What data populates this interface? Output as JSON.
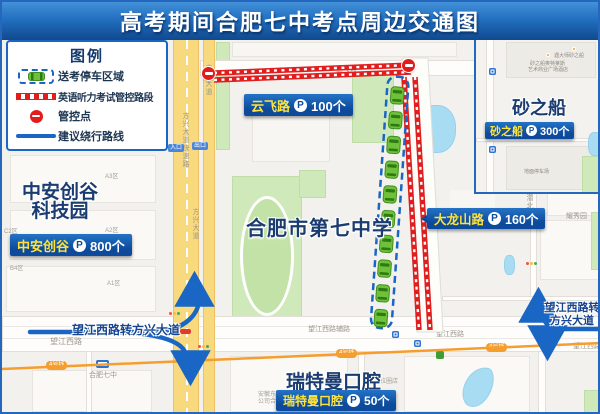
{
  "title": "高考期间合肥七中考点周边交通图",
  "legend": {
    "title": "图例",
    "items": [
      {
        "label": "送考停车区域"
      },
      {
        "label": "英语听力考试管控路段"
      },
      {
        "label": "管控点"
      },
      {
        "label": "建议绕行路线"
      }
    ]
  },
  "p_badge": "P",
  "banners": {
    "yunfei": {
      "name": "云飞路",
      "count": "100个"
    },
    "dalongshan": {
      "name": "大龙山路",
      "count": "160个"
    },
    "zhongan": {
      "name": "中安创谷",
      "count": "800个"
    },
    "shazhichuan": {
      "name": "砂之船",
      "count": "300个"
    },
    "ruiteman": {
      "name": "瑞特曼口腔",
      "count": "50个"
    }
  },
  "places": {
    "zhongan_campus_line1": "中安创谷",
    "zhongan_campus_line2": "科技园",
    "school": "合肥市第七中学",
    "shazhichuan": "砂之船",
    "dental": "瑞特曼口腔"
  },
  "route_notes": {
    "left": "望江西路转方兴大道",
    "right_line1": "望江西路转",
    "right_line2": "方兴大道"
  },
  "road_labels": {
    "fangxing_expwy": "方兴大道快速路",
    "fangxing": "方兴大道",
    "yunfei": "云飞路",
    "wangjiang": "望江西路",
    "wangjiang_fulu": "望江西路辅路",
    "qianbei": "潜北",
    "yaoxiuyuan": "耀秀园",
    "metro_line4": "4号线",
    "station_hefei7": "合肥七中",
    "entrance": "入口",
    "exit": "出口"
  },
  "block_labels": {
    "a3": "A3区",
    "a2": "A2区",
    "c2": "C2区",
    "c1": "C1区",
    "b4": "B4区",
    "a1": "A1区"
  },
  "tiny_labels": {
    "inset_poi1": "遇大师砂之船",
    "inset_poi2": "砂之船奥特莱斯",
    "inset_poi3": "艺术商业广场酒店",
    "inset_parking": "地面停车场",
    "dental_side": "拉圈店",
    "misc1": "安徽东",
    "misc2": "公司合"
  },
  "colors": {
    "header_blue": "#1b5cab",
    "plate_blue": "#0d4a9b",
    "plate_yellow": "#ffe33a",
    "route_blue": "#1a66c4",
    "control_red": "#e01e1e",
    "bus_green": "#6fc13c",
    "road_yellow": "#f8d97e",
    "metro_orange": "#f59e2d",
    "park_green": "#cfe9ba",
    "water_blue": "#a8dcf2",
    "name_navy": "#1b3c70"
  }
}
